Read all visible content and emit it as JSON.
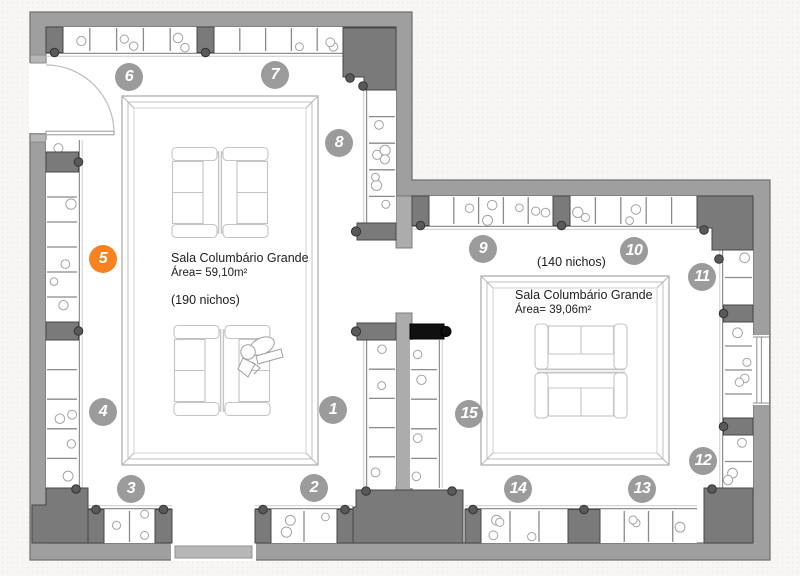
{
  "plan": {
    "rooms": {
      "large": {
        "name": "Sala Columbário Grande",
        "area_label": "Área= 59,10m²",
        "niches_label": "(190 nichos)"
      },
      "small": {
        "name": "Sala Columbário Grande",
        "area_label": "Área= 39,06m²",
        "niches_label": "(140 nichos)"
      }
    },
    "markers": [
      {
        "label": "1",
        "x": 333,
        "y": 410,
        "highlighted": false
      },
      {
        "label": "2",
        "x": 314,
        "y": 488,
        "highlighted": false
      },
      {
        "label": "3",
        "x": 131,
        "y": 489,
        "highlighted": false
      },
      {
        "label": "4",
        "x": 103,
        "y": 412,
        "highlighted": false
      },
      {
        "label": "5",
        "x": 103,
        "y": 259,
        "highlighted": true
      },
      {
        "label": "6",
        "x": 129,
        "y": 77,
        "highlighted": false
      },
      {
        "label": "7",
        "x": 275,
        "y": 75,
        "highlighted": false
      },
      {
        "label": "8",
        "x": 339,
        "y": 143,
        "highlighted": false
      },
      {
        "label": "9",
        "x": 483,
        "y": 249,
        "highlighted": false
      },
      {
        "label": "10",
        "x": 634,
        "y": 251,
        "highlighted": false
      },
      {
        "label": "11",
        "x": 702,
        "y": 277,
        "highlighted": false
      },
      {
        "label": "12",
        "x": 703,
        "y": 461,
        "highlighted": false
      },
      {
        "label": "13",
        "x": 642,
        "y": 489,
        "highlighted": false
      },
      {
        "label": "14",
        "x": 518,
        "y": 489,
        "highlighted": false
      },
      {
        "label": "15",
        "x": 469,
        "y": 414,
        "highlighted": false
      }
    ],
    "colors": {
      "wall": "#9f9f9f",
      "pier": "#7a7a7a",
      "marker": "#9b9b9b",
      "marker_highlight": "#f6831f",
      "floor": "#ffffff"
    }
  }
}
